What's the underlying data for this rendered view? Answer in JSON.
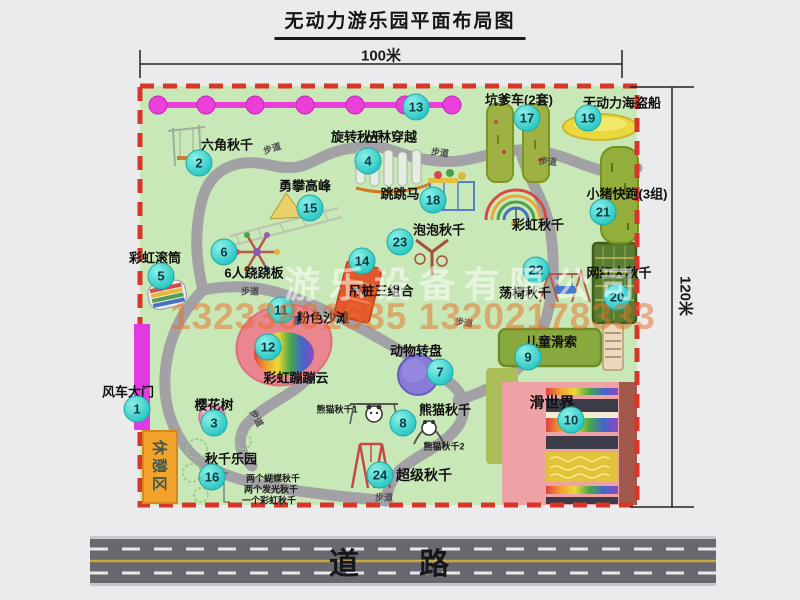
{
  "title": "无动力游乐园平面布局图",
  "dimensions": {
    "width_label": "100米",
    "height_label": "120米"
  },
  "road_label": "道  路",
  "rest_area_label": "休憩区",
  "watermark": {
    "company": "游乐设备有限公司",
    "phone": "13233801635 13202178333"
  },
  "map": {
    "trail_label": "步道",
    "trail_positions": [
      {
        "x": 272,
        "y": 148,
        "rot": -18
      },
      {
        "x": 440,
        "y": 152,
        "rot": 8
      },
      {
        "x": 548,
        "y": 161,
        "rot": 5
      },
      {
        "x": 250,
        "y": 291,
        "rot": 0
      },
      {
        "x": 257,
        "y": 418,
        "rot": 62
      },
      {
        "x": 384,
        "y": 497,
        "rot": 0
      },
      {
        "x": 464,
        "y": 322,
        "rot": 8
      }
    ],
    "features": [
      {
        "id": "windmill-gate",
        "num": 1,
        "label": "风车大门",
        "pos": [
          128,
          391
        ],
        "badge": [
          137,
          409
        ]
      },
      {
        "id": "hexagon-swing",
        "num": 2,
        "label": "六角秋千",
        "pos": [
          227,
          144
        ],
        "badge": [
          199,
          163
        ]
      },
      {
        "id": "cherry-tree",
        "num": 3,
        "label": "樱花树",
        "pos": [
          214,
          404
        ],
        "badge": [
          214,
          423
        ]
      },
      {
        "id": "rotating-swing",
        "num": 4,
        "label": "旋转秋千",
        "pos": [
          357,
          136
        ],
        "badge": [
          368,
          161
        ]
      },
      {
        "id": "rainbow-roller",
        "num": 5,
        "label": "彩虹滚筒",
        "pos": [
          155,
          257
        ],
        "badge": [
          161,
          276
        ]
      },
      {
        "id": "six-seesaw",
        "num": 6,
        "label": "6人跷跷板",
        "pos": [
          254,
          272
        ],
        "badge": [
          224,
          252
        ]
      },
      {
        "id": "animal-turntable",
        "num": 7,
        "label": "动物转盘",
        "pos": [
          416,
          350
        ],
        "badge": [
          440,
          372
        ]
      },
      {
        "id": "panda-swing",
        "num": 8,
        "label": "熊猫秋千",
        "pos": [
          445,
          409
        ],
        "badge": [
          403,
          423
        ],
        "subs": [
          {
            "text": "熊猫秋千1",
            "pos": [
              337,
              409
            ]
          },
          {
            "text": "熊猫秋千2",
            "pos": [
              444,
              446
            ]
          }
        ]
      },
      {
        "id": "kids-zipline",
        "num": 9,
        "label": "儿童滑索",
        "pos": [
          551,
          341
        ],
        "badge": [
          528,
          357
        ]
      },
      {
        "id": "slide-world",
        "num": 10,
        "label": "滑世界",
        "pos": [
          552,
          402
        ],
        "badge": [
          571,
          420
        ],
        "size": 15
      },
      {
        "id": "pink-beach",
        "num": 11,
        "label": "粉色沙滩",
        "pos": [
          323,
          317
        ],
        "badge": [
          281,
          310
        ]
      },
      {
        "id": "rainbow-cloud",
        "num": 12,
        "label": "彩虹蹦蹦云",
        "pos": [
          296,
          377
        ],
        "badge": [
          268,
          347
        ]
      },
      {
        "id": "jungle-crossing",
        "num": 13,
        "label": "丛林穿越",
        "pos": [
          391,
          136
        ],
        "badge": [
          416,
          107
        ]
      },
      {
        "id": "hanging-piles",
        "num": 14,
        "label": "吊桩三组合",
        "pos": [
          381,
          290
        ],
        "badge": [
          362,
          261
        ]
      },
      {
        "id": "peak-climb",
        "num": 15,
        "label": "勇攀高峰",
        "pos": [
          305,
          185
        ],
        "badge": [
          310,
          208
        ]
      },
      {
        "id": "swing-park",
        "num": 16,
        "label": "秋千乐园",
        "pos": [
          231,
          458
        ],
        "badge": [
          212,
          477
        ],
        "subs": [
          {
            "text": "两个蝴蝶秋千",
            "pos": [
              273,
              478
            ]
          },
          {
            "text": "两个发光秋千",
            "pos": [
              271,
              489
            ]
          },
          {
            "text": "一个彩虹秋千",
            "pos": [
              269,
              500
            ]
          }
        ]
      },
      {
        "id": "pit-car",
        "num": 17,
        "label": "坑爹车(2套)",
        "pos": [
          519,
          99
        ],
        "badge": [
          527,
          118
        ]
      },
      {
        "id": "jumping-horse",
        "num": 18,
        "label": "跳跳马",
        "pos": [
          400,
          193
        ],
        "badge": [
          433,
          200
        ]
      },
      {
        "id": "pirate-ship",
        "num": 19,
        "label": "无动力海盗船",
        "pos": [
          622,
          102
        ],
        "badge": [
          588,
          118
        ]
      },
      {
        "id": "big-swing",
        "num": 20,
        "label": "网红大秋千",
        "pos": [
          619,
          272
        ],
        "badge": [
          617,
          297
        ]
      },
      {
        "id": "piggy-run",
        "num": 21,
        "label": "小猪快跑(3组)",
        "pos": [
          627,
          193
        ],
        "badge": [
          603,
          212
        ]
      },
      {
        "id": "chair-swing",
        "num": 22,
        "label": "荡椅秋千",
        "pos": [
          525,
          292
        ],
        "badge": [
          536,
          270
        ]
      },
      {
        "id": "bubble-swing",
        "num": 23,
        "label": "泡泡秋千",
        "pos": [
          439,
          229
        ],
        "badge": [
          400,
          242
        ]
      },
      {
        "id": "super-swing",
        "num": 24,
        "label": "超级秋千",
        "pos": [
          424,
          475
        ],
        "badge": [
          380,
          475
        ],
        "size": 14
      },
      {
        "id": "rainbow-swing",
        "num": null,
        "label": "彩虹秋千",
        "pos": [
          538,
          224
        ]
      }
    ]
  },
  "colors": {
    "park_green": "#c9e8b7",
    "boundary_red": "#d8352b",
    "path_gray": "#a2a2a6",
    "zipline_magenta": "#ea3fd9",
    "gate_magenta": "#e23ae2",
    "rest_orange": "#f3a32c",
    "badge_teal": "#2ec9c5",
    "road_gray": "#686870",
    "road_yellow": "#c8a83c"
  }
}
